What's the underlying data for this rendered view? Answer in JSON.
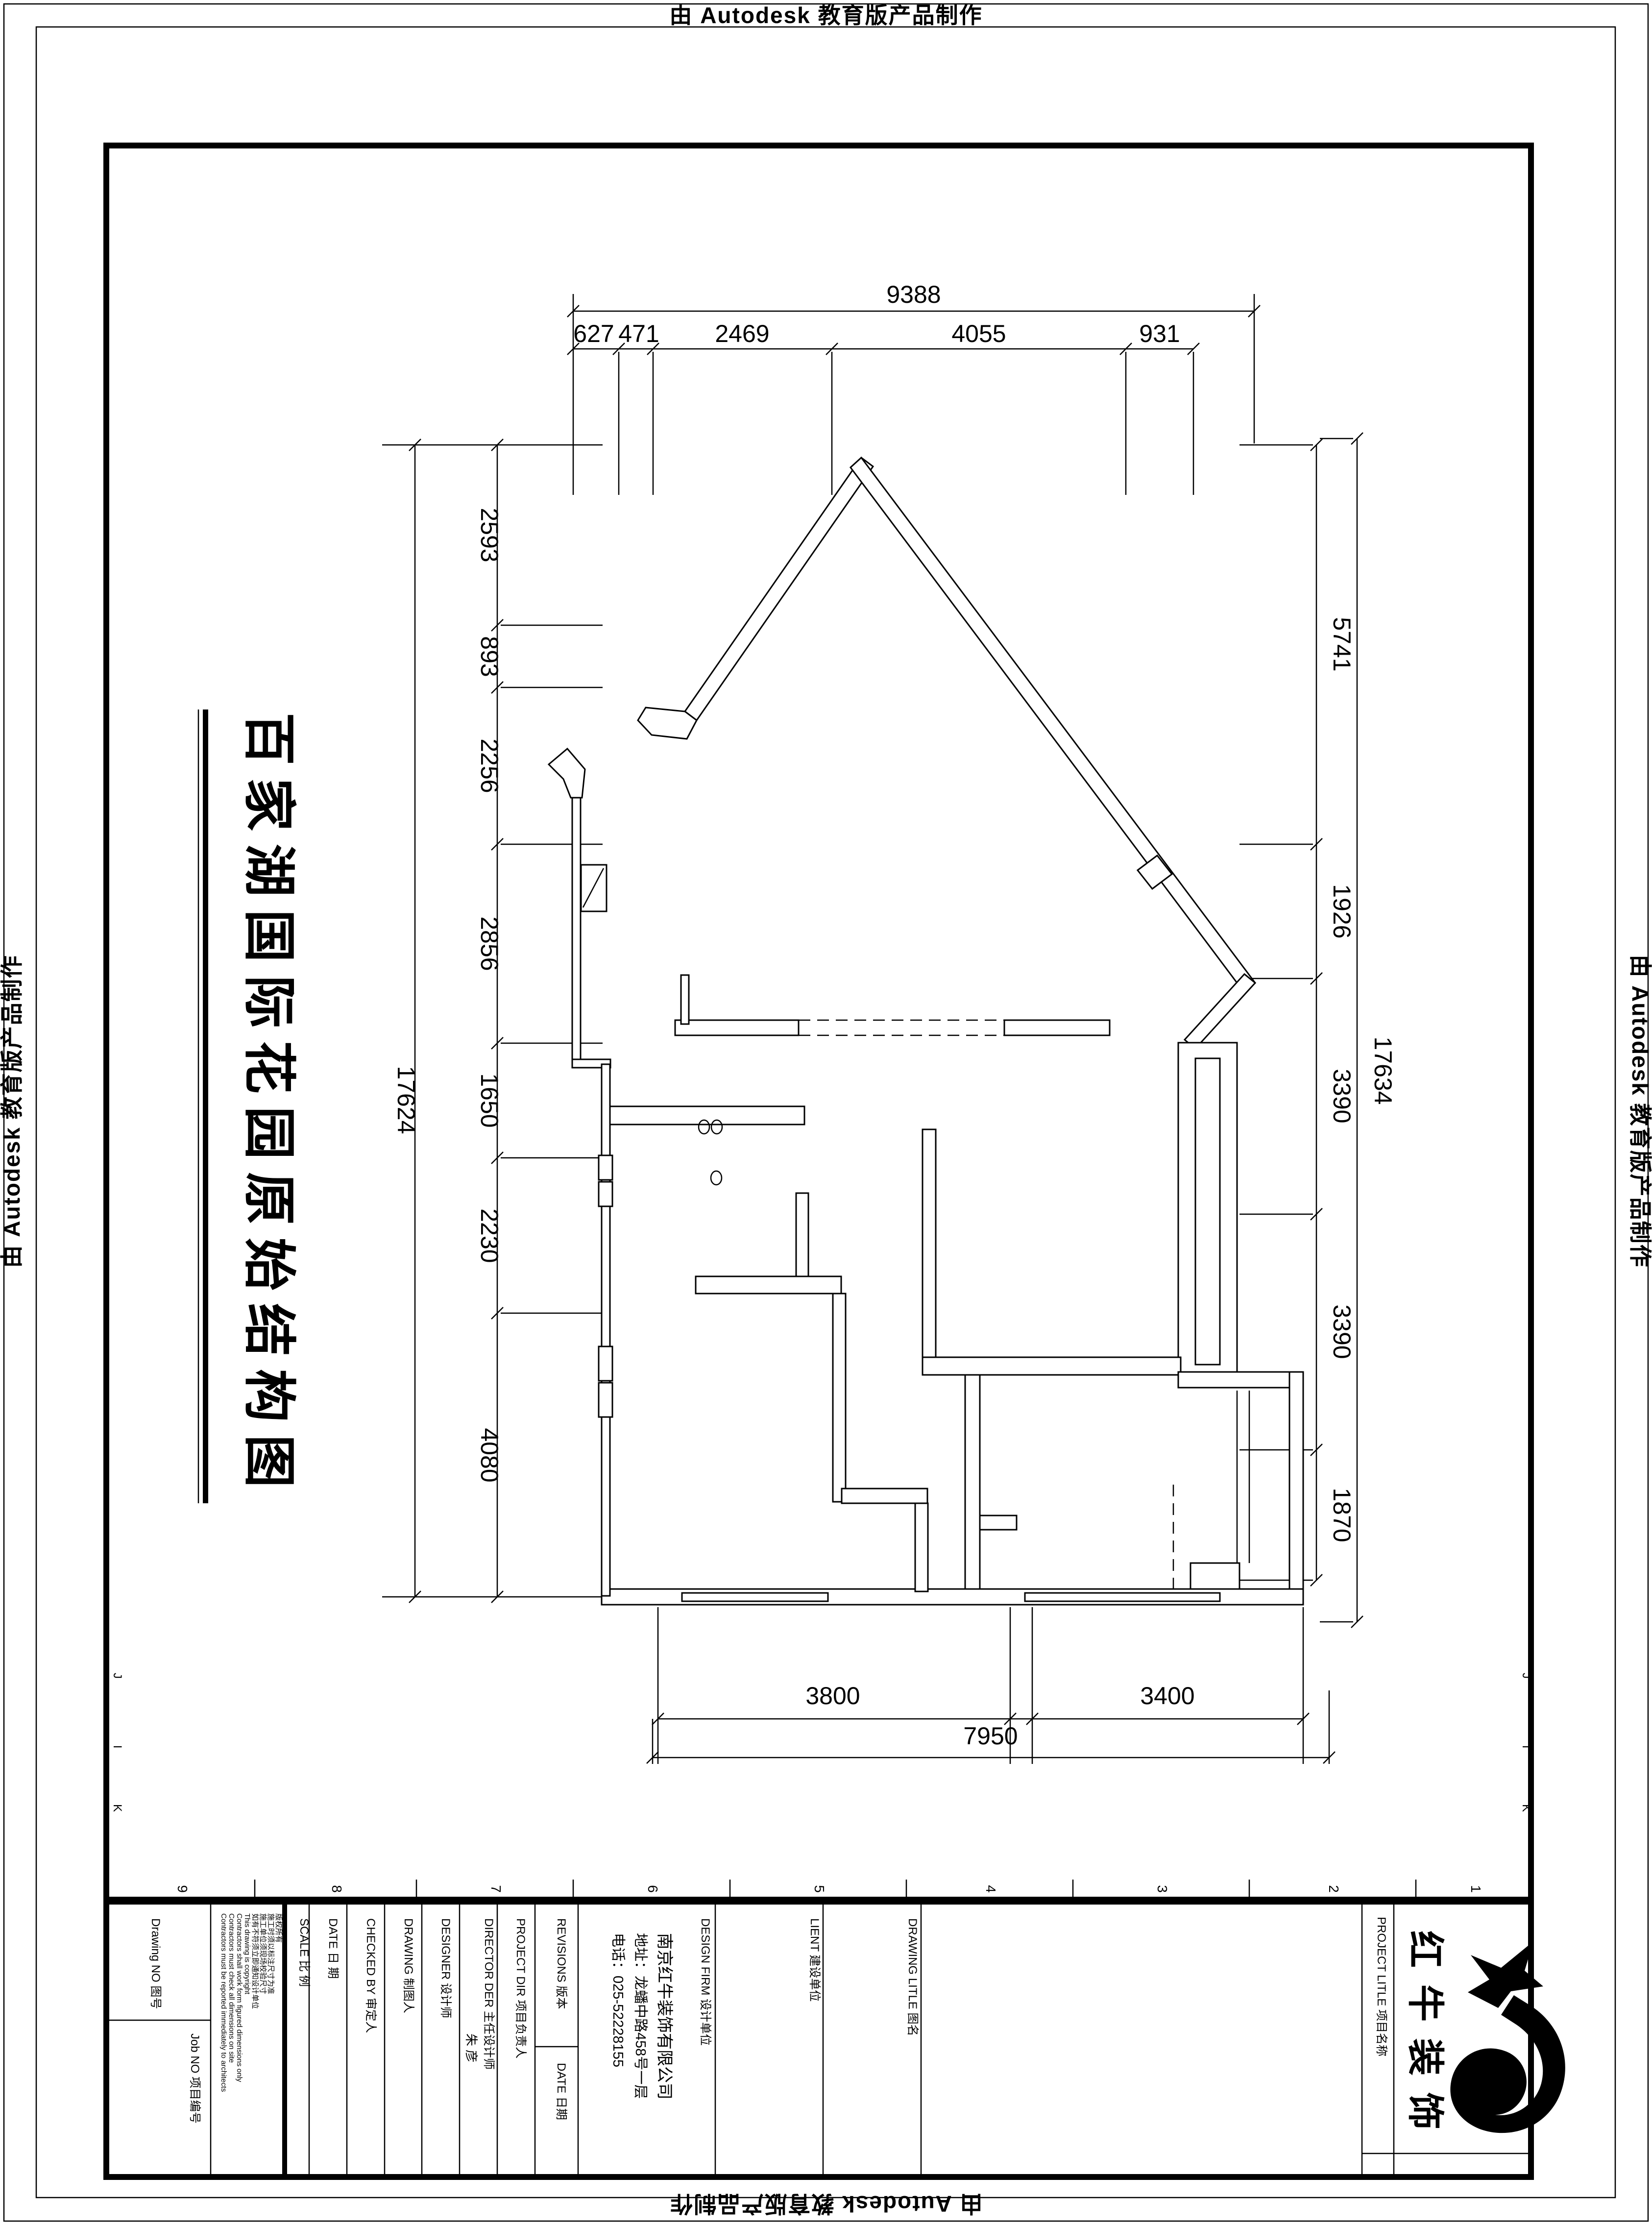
{
  "watermark": {
    "text": "由 Autodesk 教育版产品制作"
  },
  "sheet": {
    "title": "百家湖国际花园原始结构图"
  },
  "dims": {
    "top": {
      "total": "9388",
      "segments": [
        "627",
        "471",
        "2469",
        "4055",
        "931"
      ]
    },
    "left": {
      "total": "17624",
      "segments": [
        "2593",
        "893",
        "2256",
        "2856",
        "1650",
        "2230",
        "4080"
      ]
    },
    "right": {
      "total": "17634",
      "segments": [
        "5741",
        "1926",
        "3390",
        "3390",
        "1870"
      ]
    },
    "bottom": {
      "total": "7950",
      "segments": [
        "3800",
        "3400"
      ]
    }
  },
  "grid": {
    "columns": [
      "9",
      "8",
      "7",
      "6",
      "5",
      "4",
      "3",
      "2",
      "1"
    ],
    "rows": [
      "J",
      "I",
      "K"
    ]
  },
  "titleblock": {
    "drawing_no_label": "Drawing NO 图号",
    "job_no_label": "Job NO 项目编号",
    "copyright_lines": [
      "版权所有",
      "施工时须以标注尺寸为准",
      "施工单位须现场校验尺寸",
      "如有不符须立即通知设计单位",
      "This drawing is copyright",
      "Contractors shall work form figured dimensions only",
      "Contractors must check all dimensions on site",
      "Contractors must be reported immediately to architects"
    ],
    "scale_label": "SCALE  比 例",
    "date_label": "DATE  日 期",
    "checked_label": "CHECKED BY  审定人",
    "drawing_label": "DRAWING  制图人",
    "designer_label": "DESIGNER  设计师",
    "director_label": "DIRECTOR DER 主任设计师",
    "director_value": "朱 彦",
    "project_dir_label": "PROJECT DIR  项目负责人",
    "revisions_label": "REVISIONS  版本",
    "revisions_date_label": "DATE  日期",
    "design_firm_label": "DESIGN FIRM  设计单位",
    "firm_name": "南京红牛装饰有限公司",
    "firm_address": "地址：龙蟠中路458号一层",
    "firm_phone": "电话：025-52228155",
    "client_label": "LIENT  建设单位",
    "drawing_title_label": "DRAWING LITLE  图名",
    "project_title_label": "PROJECT LITLE 项目名称",
    "logo_text": "红牛装饰"
  },
  "colors": {
    "line": "#000000",
    "background": "#ffffff"
  }
}
